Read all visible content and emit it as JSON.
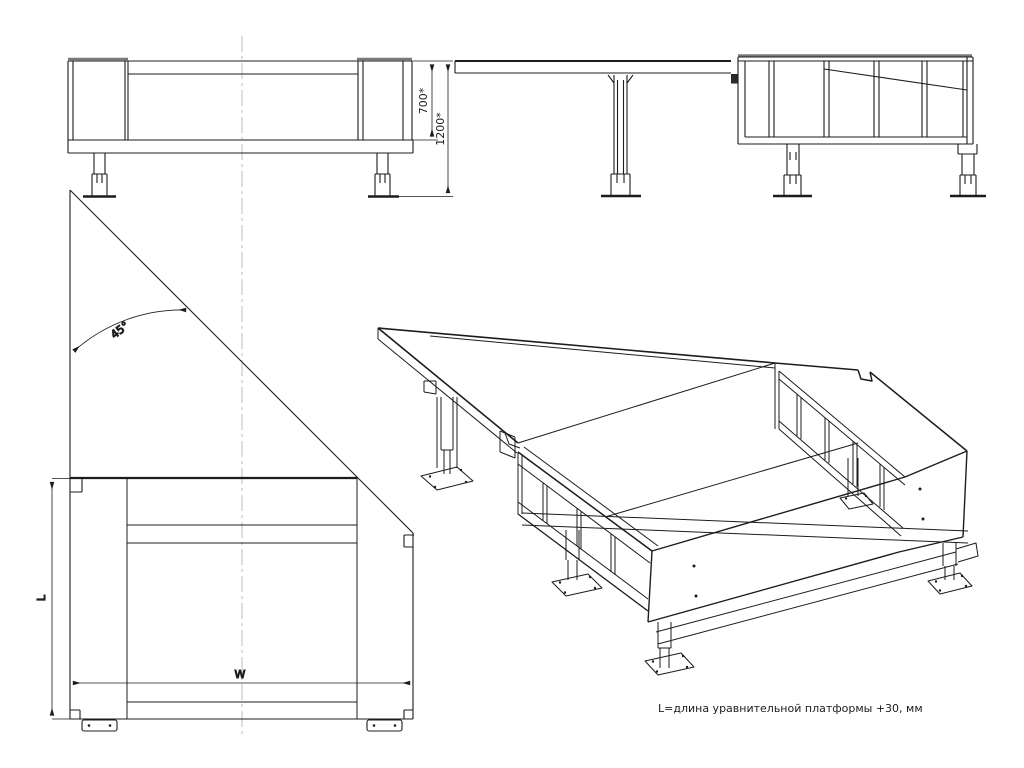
{
  "drawing": {
    "type": "technical-drawing",
    "subject": "dock leveller pit frame",
    "note": "L=длина уравнительной платформы  +30, мм",
    "views": {
      "front": {
        "dim_upper": "700*",
        "dim_total": "1200*"
      },
      "side": {},
      "plan": {
        "angle": "45°",
        "length_label": "L",
        "width_label": "W"
      },
      "isometric": {}
    },
    "colors": {
      "line": "#1c1c1c",
      "centerline": "#bdbdbd",
      "cap_edge": "#7a7a7a",
      "background": "#ffffff"
    }
  }
}
